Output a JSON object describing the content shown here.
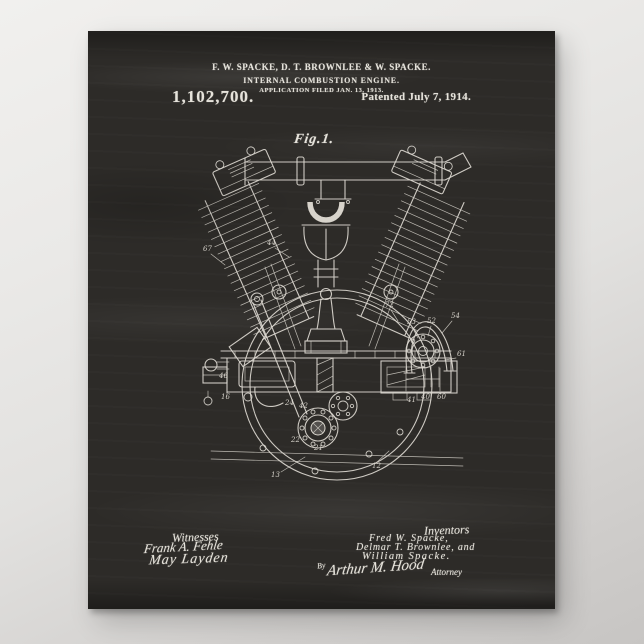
{
  "poster": {
    "header": {
      "names_line": "F. W. SPACKE, D. T. BROWNLEE & W. SPACKE.",
      "title_line": "INTERNAL COMBUSTION ENGINE.",
      "application_line": "APPLICATION FILED JAN. 13, 1913.",
      "patent_number": "1,102,700.",
      "patented_line": "Patented July 7, 1914."
    },
    "figure_label": "Fig.1.",
    "witnesses": {
      "label": "Witnesses",
      "signature_1": "Frank A. Fehle",
      "signature_2": "May Layden"
    },
    "inventors": {
      "label": "Inventors",
      "name_1": "Fred W. Spacke,",
      "name_2": "Delmar T. Brownlee, and",
      "name_3": "William Spacke.",
      "by": "By",
      "attorney_signature": "Arthur M. Hood",
      "attorney_label": "Attorney"
    },
    "colors": {
      "chalkboard": "#2d2b28",
      "chalk": "#e6e3db",
      "page_background": "#e9e8e6"
    }
  },
  "engine": {
    "labels": [
      "44",
      "67",
      "72",
      "53",
      "52",
      "54",
      "61",
      "46",
      "16",
      "24",
      "42",
      "22",
      "21",
      "40",
      "41",
      "60",
      "13",
      "12"
    ]
  }
}
